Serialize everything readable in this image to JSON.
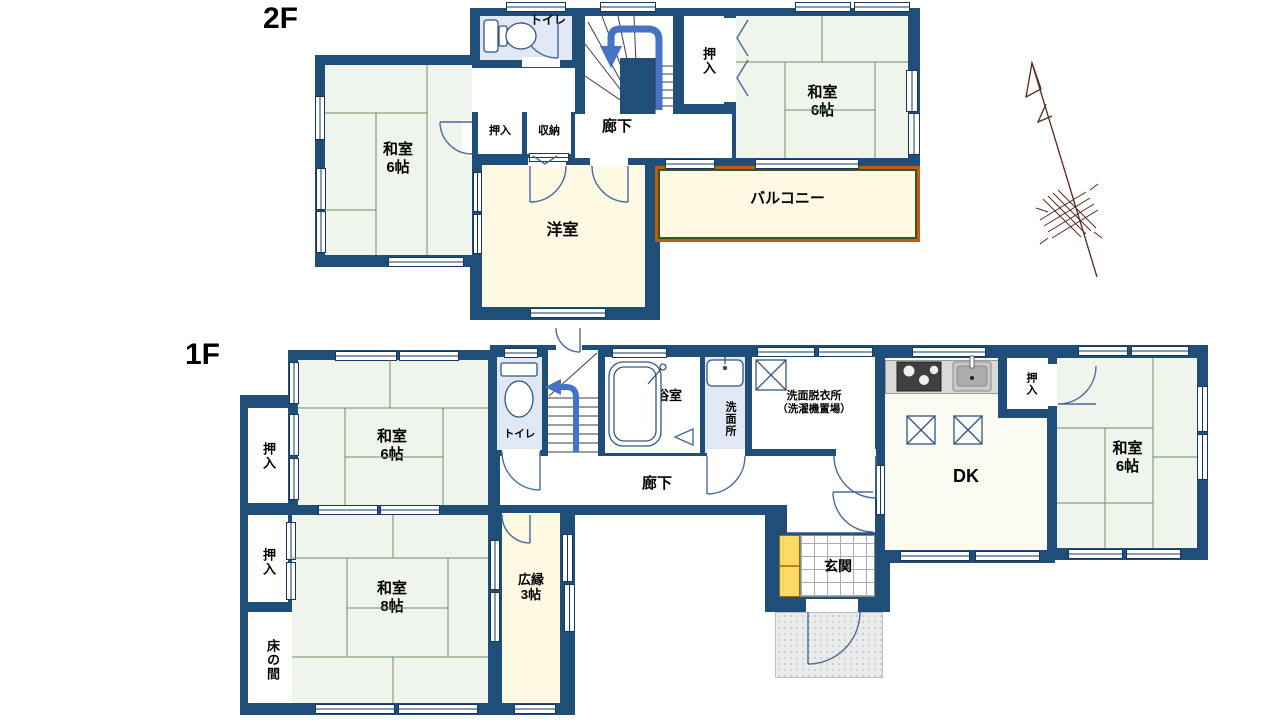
{
  "colors": {
    "wall": "#1F4E79",
    "tatami_floor": "#EFF5EC",
    "tatami_line": "#6A9162",
    "cream_floor": "#FDF9E3",
    "light_blue_floor": "#DFE8F4",
    "dk_floor": "#FBFAF1",
    "balcony_border_orange": "#C55A11",
    "balcony_border_green": "#375623",
    "stairs_arrow_blue": "#4472C4",
    "door_line": "#4A6A9A",
    "compass_maroon": "#582720",
    "shoe_cabinet_yellow": "#FFD966"
  },
  "floor2": {
    "label": "2F",
    "rooms": {
      "toilet": "トイレ",
      "hallway": "廊下",
      "closet_small": "押入",
      "storage": "収納",
      "closet": "押入",
      "washitsu_left": {
        "name": "和室",
        "size": "6帖"
      },
      "washitsu_right": {
        "name": "和室",
        "size": "6帖"
      },
      "youshitsu": "洋室",
      "balcony": "バルコニー"
    }
  },
  "floor1": {
    "label": "1F",
    "rooms": {
      "closet_nw": "押入",
      "washitsu_nw": {
        "name": "和室",
        "size": "6帖"
      },
      "toilet": "トイレ",
      "bath": "浴室",
      "washroom": "洗面所",
      "laundry": {
        "line1": "洗面脱衣所",
        "line2": "（洗濯機置場）"
      },
      "hallway": "廊下",
      "dk": "DK",
      "closet_dk": "押入",
      "washitsu_east": {
        "name": "和室",
        "size": "6帖"
      },
      "genkan": "玄関",
      "closet_west": "押入",
      "tokonoma": "床の間",
      "washitsu_south": {
        "name": "和室",
        "size": "8帖"
      },
      "hiroen": {
        "line1": "広縁",
        "line2": "3帖"
      }
    }
  }
}
